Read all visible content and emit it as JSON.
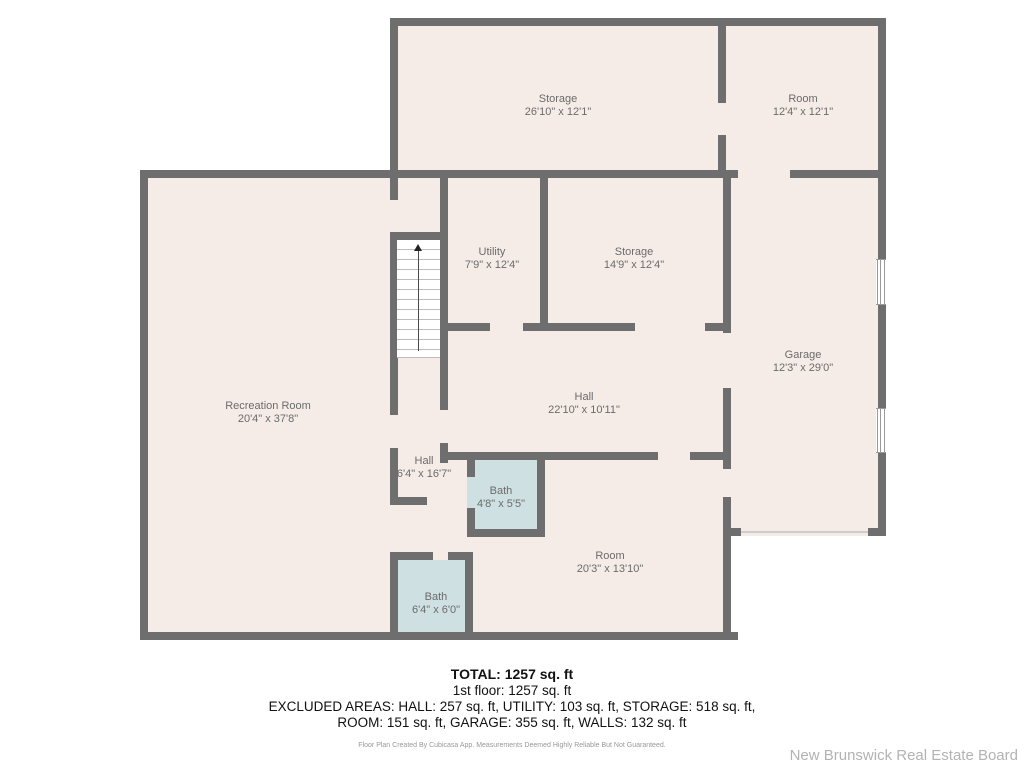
{
  "floorplan": {
    "rooms": [
      {
        "label": "Storage",
        "dims": "26'10\" x 12'1\""
      },
      {
        "label": "Room",
        "dims": "12'4\" x 12'1\""
      },
      {
        "label": "Utility",
        "dims": "7'9\" x 12'4\""
      },
      {
        "label": "Storage",
        "dims": "14'9\" x 12'4\""
      },
      {
        "label": "Garage",
        "dims": "12'3\" x 29'0\""
      },
      {
        "label": "Recreation Room",
        "dims": "20'4\" x 37'8\""
      },
      {
        "label": "Hall",
        "dims": "22'10\" x 10'11\""
      },
      {
        "label": "Hall",
        "dims": "6'4\" x 16'7\""
      },
      {
        "label": "Bath",
        "dims": "4'8\" x 5'5\""
      },
      {
        "label": "Room",
        "dims": "20'3\" x 13'10\""
      },
      {
        "label": "Bath",
        "dims": "6'4\" x 6'0\""
      }
    ],
    "colors": {
      "wall": "#6e6e6e",
      "room_fill": "#f5ece8",
      "bath_fill": "#cfe0e2",
      "stairs_fill": "#ffffff",
      "label_text": "#6b6b6b"
    }
  },
  "summary": {
    "total": "TOTAL: 1257 sq. ft",
    "first_floor": "1st floor: 1257 sq. ft",
    "excluded_line1": "EXCLUDED AREAS: HALL: 257 sq. ft, UTILITY: 103 sq. ft, STORAGE: 518 sq. ft,",
    "excluded_line2": "ROOM: 151 sq. ft, GARAGE: 355 sq. ft, WALLS: 132 sq. ft",
    "disclaimer": "Floor Plan Created By Cubicasa App. Measurements Deemed Highly Reliable But Not Guaranteed."
  },
  "watermark": "New Brunswick Real Estate Board"
}
